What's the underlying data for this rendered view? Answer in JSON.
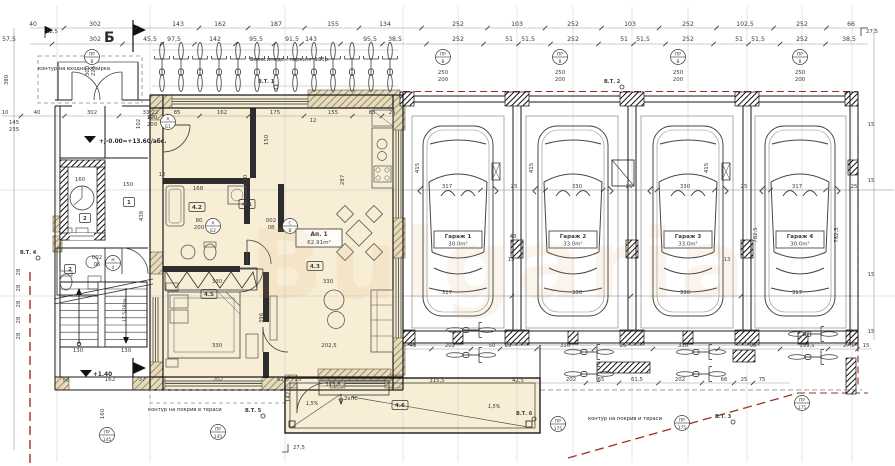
{
  "meta": {
    "type": "architectural-floor-plan",
    "language": "bg"
  },
  "palette": {
    "paper": "#ffffff",
    "ink": "#1a1a1a",
    "dim_text": "#3c3c3c",
    "grid": "#c9c9c9",
    "highlight": "#f8eed6",
    "hatch_tan": "#8a7a55",
    "red_boundary": "#9e2f23",
    "furniture": "#555555",
    "watermark": "#d9a05b"
  },
  "watermark": "Bulgaria",
  "section_marker": "Б",
  "texts": {
    "canopy": "контур на входна козирка",
    "bike_parking": "Велосипеден паркинг 13бр.",
    "roof_terrace_a": "контур на покрив в тераси",
    "roof_terrace_b": "контур на покрив и тераси",
    "level_zero": "+/-0.00=+13.60/абс.",
    "level_stair": "+1.40",
    "stair_note": "17,5/28см.",
    "drain": "2хЛС",
    "slope": "1,5%"
  },
  "apartment": {
    "label": "Ап. 1",
    "area": "62.91m²"
  },
  "rooms": [
    {
      "id": "4.1",
      "x": 247,
      "y": 206
    },
    {
      "id": "4.2",
      "x": 197,
      "y": 209
    },
    {
      "id": "4.3",
      "x": 315,
      "y": 268
    },
    {
      "id": "4.5",
      "x": 209,
      "y": 296
    },
    {
      "id": "4.6",
      "x": 400,
      "y": 407
    },
    {
      "id": "1",
      "x": 129,
      "y": 204
    },
    {
      "id": "2",
      "x": 85,
      "y": 220
    },
    {
      "id": "2",
      "x": 70,
      "y": 271
    }
  ],
  "garages": [
    {
      "name": "Гараж 1",
      "area": "30.0m²",
      "cx": 458
    },
    {
      "name": "Гараж 2",
      "area": "33.0m²",
      "cx": 573
    },
    {
      "name": "Гараж 3",
      "area": "33.0m²",
      "cx": 688
    },
    {
      "name": "Гараж 4",
      "area": "30.0m²",
      "cx": 800
    }
  ],
  "bt_markers": [
    {
      "label": "В.Т. 1",
      "x": 258,
      "y": 83
    },
    {
      "label": "В.Т. 2",
      "x": 604,
      "y": 83
    },
    {
      "label": "В.Т. 4",
      "x": 20,
      "y": 254
    },
    {
      "label": "В.Т. 5",
      "x": 245,
      "y": 412
    },
    {
      "label": "В.Т. 6",
      "x": 516,
      "y": 415
    },
    {
      "label": "В.Т. 3",
      "x": 715,
      "y": 418
    }
  ],
  "door_tags": [
    {
      "a": "ПР",
      "b": "В",
      "x": 92,
      "y": 57
    },
    {
      "a": "А",
      "b": "Б1",
      "x": 168,
      "y": 122
    },
    {
      "a": "А",
      "b": "Б2",
      "x": 213,
      "y": 226
    },
    {
      "a": "С",
      "b": "В",
      "x": 290,
      "y": 226
    },
    {
      "a": "Н",
      "b": "4",
      "x": 113,
      "y": 263
    },
    {
      "a": "ПР",
      "b": "В",
      "x": 443,
      "y": 57
    },
    {
      "a": "ПР",
      "b": "В",
      "x": 560,
      "y": 57
    },
    {
      "a": "ПР",
      "b": "В",
      "x": 678,
      "y": 57
    },
    {
      "a": "ПР",
      "b": "В",
      "x": 800,
      "y": 57
    },
    {
      "a": "ПР",
      "b": "145",
      "x": 107,
      "y": 435
    },
    {
      "a": "ПР",
      "b": "145",
      "x": 218,
      "y": 432
    },
    {
      "a": "ПР",
      "b": "175",
      "x": 558,
      "y": 424
    },
    {
      "a": "ПР",
      "b": "175",
      "x": 682,
      "y": 423
    },
    {
      "a": "ПР",
      "b": "175",
      "x": 802,
      "y": 403
    }
  ],
  "dims": [
    {
      "t": "40",
      "x": 33,
      "y": 26,
      "row": "r1"
    },
    {
      "t": "302",
      "x": 95,
      "y": 26,
      "row": "r1"
    },
    {
      "t": "143",
      "x": 178,
      "y": 26,
      "row": "r1"
    },
    {
      "t": "162",
      "x": 220,
      "y": 26,
      "row": "r1"
    },
    {
      "t": "187",
      "x": 276,
      "y": 26,
      "row": "r1"
    },
    {
      "t": "155",
      "x": 333,
      "y": 26,
      "row": "r1"
    },
    {
      "t": "134",
      "x": 385,
      "y": 26,
      "row": "r1"
    },
    {
      "t": "252",
      "x": 458,
      "y": 26,
      "row": "r1"
    },
    {
      "t": "103",
      "x": 517,
      "y": 26,
      "row": "r1"
    },
    {
      "t": "252",
      "x": 573,
      "y": 26,
      "row": "r1"
    },
    {
      "t": "103",
      "x": 630,
      "y": 26,
      "row": "r1"
    },
    {
      "t": "252",
      "x": 688,
      "y": 26,
      "row": "r1"
    },
    {
      "t": "102,5",
      "x": 745,
      "y": 26,
      "row": "r1"
    },
    {
      "t": "252",
      "x": 802,
      "y": 26,
      "row": "r1"
    },
    {
      "t": "66",
      "x": 851,
      "y": 26,
      "row": "r1"
    },
    {
      "t": "57,5",
      "x": 9,
      "y": 41,
      "row": "r2"
    },
    {
      "t": "302",
      "x": 95,
      "y": 41,
      "row": "r2"
    },
    {
      "t": "45,5",
      "x": 150,
      "y": 41,
      "row": "r2"
    },
    {
      "t": "97,5",
      "x": 174,
      "y": 41,
      "row": "r2"
    },
    {
      "t": "142",
      "x": 215,
      "y": 41,
      "row": "r2"
    },
    {
      "t": "95,5",
      "x": 256,
      "y": 41,
      "row": "r2"
    },
    {
      "t": "91,5",
      "x": 292,
      "y": 41,
      "row": "r2"
    },
    {
      "t": "143",
      "x": 311,
      "y": 41,
      "row": "r2"
    },
    {
      "t": "95,5",
      "x": 370,
      "y": 41,
      "row": "r2"
    },
    {
      "t": "38,5",
      "x": 395,
      "y": 41,
      "row": "r2"
    },
    {
      "t": "252",
      "x": 458,
      "y": 41,
      "row": "r2"
    },
    {
      "t": "51",
      "x": 509,
      "y": 41,
      "row": "r2"
    },
    {
      "t": "51,5",
      "x": 528,
      "y": 41,
      "row": "r2"
    },
    {
      "t": "252",
      "x": 573,
      "y": 41,
      "row": "r2"
    },
    {
      "t": "51",
      "x": 624,
      "y": 41,
      "row": "r2"
    },
    {
      "t": "51,5",
      "x": 643,
      "y": 41,
      "row": "r2"
    },
    {
      "t": "252",
      "x": 688,
      "y": 41,
      "row": "r2"
    },
    {
      "t": "51",
      "x": 739,
      "y": 41,
      "row": "r2"
    },
    {
      "t": "51,5",
      "x": 758,
      "y": 41,
      "row": "r2"
    },
    {
      "t": "252",
      "x": 802,
      "y": 41,
      "row": "r2"
    },
    {
      "t": "38,5",
      "x": 849,
      "y": 41,
      "row": "r2"
    },
    {
      "t": "12,5",
      "x": 52,
      "y": 33
    },
    {
      "t": "27,5",
      "x": 872,
      "y": 33
    },
    {
      "t": "10",
      "x": 5,
      "y": 114,
      "row": "r3"
    },
    {
      "t": "40",
      "x": 37,
      "y": 114,
      "row": "r3"
    },
    {
      "t": "302",
      "x": 92,
      "y": 114,
      "row": "r3"
    },
    {
      "t": "33",
      "x": 146,
      "y": 114,
      "row": "r3"
    },
    {
      "t": "22",
      "x": 155,
      "y": 114,
      "row": "r3"
    },
    {
      "t": "85",
      "x": 177,
      "y": 114,
      "row": "r3"
    },
    {
      "t": "162",
      "x": 222,
      "y": 114,
      "row": "r3"
    },
    {
      "t": "175",
      "x": 275,
      "y": 114,
      "row": "r3"
    },
    {
      "t": "155",
      "x": 333,
      "y": 114,
      "row": "r3"
    },
    {
      "t": "83",
      "x": 372,
      "y": 114,
      "row": "r3"
    },
    {
      "t": "25",
      "x": 392,
      "y": 114,
      "row": "r3"
    },
    {
      "t": "317",
      "x": 447,
      "y": 188,
      "row": "g1"
    },
    {
      "t": "25",
      "x": 514,
      "y": 188,
      "row": "g1"
    },
    {
      "t": "330",
      "x": 577,
      "y": 188,
      "row": "g1"
    },
    {
      "t": "25",
      "x": 629,
      "y": 188,
      "row": "g1"
    },
    {
      "t": "330",
      "x": 685,
      "y": 188,
      "row": "g1"
    },
    {
      "t": "25",
      "x": 744,
      "y": 188,
      "row": "g1"
    },
    {
      "t": "317",
      "x": 797,
      "y": 188,
      "row": "g1"
    },
    {
      "t": "25",
      "x": 854,
      "y": 188,
      "row": "g1"
    },
    {
      "t": "317",
      "x": 447,
      "y": 294,
      "row": "g2"
    },
    {
      "t": "330",
      "x": 577,
      "y": 294,
      "row": "g2"
    },
    {
      "t": "330",
      "x": 685,
      "y": 294,
      "row": "g2"
    },
    {
      "t": "317",
      "x": 797,
      "y": 294,
      "row": "g2"
    },
    {
      "t": "45",
      "x": 413,
      "y": 347,
      "row": "g3"
    },
    {
      "t": "202",
      "x": 450,
      "y": 347,
      "row": "g3"
    },
    {
      "t": "50",
      "x": 492,
      "y": 347,
      "row": "g3"
    },
    {
      "t": "25",
      "x": 508,
      "y": 347,
      "row": "g3"
    },
    {
      "t": "330",
      "x": 565,
      "y": 347,
      "row": "g3"
    },
    {
      "t": "25",
      "x": 623,
      "y": 347,
      "row": "g3"
    },
    {
      "t": "330",
      "x": 683,
      "y": 347,
      "row": "g3"
    },
    {
      "t": "90",
      "x": 753,
      "y": 347,
      "row": "g3"
    },
    {
      "t": "199,5",
      "x": 807,
      "y": 347,
      "row": "g3"
    },
    {
      "t": "27,5",
      "x": 849,
      "y": 347,
      "row": "g3"
    },
    {
      "t": "15",
      "x": 866,
      "y": 347,
      "row": "g3"
    },
    {
      "t": "202",
      "x": 571,
      "y": 381,
      "row": "g4"
    },
    {
      "t": "65",
      "x": 601,
      "y": 381,
      "row": "g4"
    },
    {
      "t": "61,5",
      "x": 637,
      "y": 381,
      "row": "g4"
    },
    {
      "t": "202",
      "x": 680,
      "y": 381,
      "row": "g4"
    },
    {
      "t": "66",
      "x": 724,
      "y": 381,
      "row": "g4"
    },
    {
      "t": "25",
      "x": 744,
      "y": 381,
      "row": "g4"
    },
    {
      "t": "75",
      "x": 762,
      "y": 381,
      "row": "g4"
    },
    {
      "t": "313,5",
      "x": 333,
      "y": 386
    },
    {
      "t": "315,5",
      "x": 437,
      "y": 382
    },
    {
      "t": "42,5",
      "x": 518,
      "y": 382
    },
    {
      "t": "202",
      "x": 218,
      "y": 381
    },
    {
      "t": "62,5",
      "x": 283,
      "y": 381
    },
    {
      "t": "25",
      "x": 298,
      "y": 381
    },
    {
      "t": "162",
      "x": 110,
      "y": 381
    },
    {
      "t": "37",
      "x": 142,
      "y": 381
    },
    {
      "t": "56",
      "x": 66,
      "y": 382
    },
    {
      "t": "380",
      "x": 8,
      "y": 80,
      "v": 1
    },
    {
      "t": "102",
      "x": 140,
      "y": 124,
      "v": 1
    },
    {
      "t": "150",
      "x": 268,
      "y": 140,
      "v": 1
    },
    {
      "t": "170",
      "x": 247,
      "y": 180,
      "v": 1
    },
    {
      "t": "287",
      "x": 344,
      "y": 180,
      "v": 1
    },
    {
      "t": "396",
      "x": 263,
      "y": 318,
      "v": 1
    },
    {
      "t": "438",
      "x": 143,
      "y": 216,
      "v": 1
    },
    {
      "t": "415",
      "x": 419,
      "y": 168,
      "v": 1
    },
    {
      "t": "415",
      "x": 533,
      "y": 168,
      "v": 1
    },
    {
      "t": "415",
      "x": 708,
      "y": 168,
      "v": 1
    },
    {
      "t": "782,5",
      "x": 757,
      "y": 235,
      "v": 1
    },
    {
      "t": "782,5",
      "x": 838,
      "y": 235,
      "v": 1
    },
    {
      "t": "160",
      "x": 104,
      "y": 414,
      "v": 1
    },
    {
      "t": "142",
      "x": 290,
      "y": 397,
      "v": 1
    },
    {
      "t": "300",
      "x": 89,
      "y": 71,
      "v": 1
    },
    {
      "t": "225",
      "x": 95,
      "y": 71,
      "v": 1
    },
    {
      "t": "28",
      "x": 20,
      "y": 272,
      "v": 1
    },
    {
      "t": "28",
      "x": 20,
      "y": 288,
      "v": 1
    },
    {
      "t": "28",
      "x": 20,
      "y": 304,
      "v": 1
    },
    {
      "t": "28",
      "x": 20,
      "y": 320,
      "v": 1
    },
    {
      "t": "28",
      "x": 20,
      "y": 336,
      "v": 1
    },
    {
      "t": "145",
      "x": 14,
      "y": 124
    },
    {
      "t": "235",
      "x": 14,
      "y": 131
    },
    {
      "t": "160",
      "x": 80,
      "y": 181
    },
    {
      "t": "150",
      "x": 128,
      "y": 186
    },
    {
      "t": "168",
      "x": 198,
      "y": 190
    },
    {
      "t": "330",
      "x": 217,
      "y": 283
    },
    {
      "t": "330",
      "x": 328,
      "y": 283
    },
    {
      "t": "330",
      "x": 217,
      "y": 347
    },
    {
      "t": "202,5",
      "x": 329,
      "y": 347
    },
    {
      "t": "130",
      "x": 78,
      "y": 352
    },
    {
      "t": "130",
      "x": 126,
      "y": 352
    },
    {
      "t": "12",
      "x": 313,
      "y": 122
    },
    {
      "t": "12",
      "x": 162,
      "y": 176
    },
    {
      "t": "43",
      "x": 513,
      "y": 238
    },
    {
      "t": "13",
      "x": 511,
      "y": 261
    },
    {
      "t": "13",
      "x": 727,
      "y": 261
    },
    {
      "t": "15",
      "x": 871,
      "y": 126
    },
    {
      "t": "15",
      "x": 871,
      "y": 182
    },
    {
      "t": "15",
      "x": 871,
      "y": 276
    },
    {
      "t": "15",
      "x": 871,
      "y": 333
    },
    {
      "t": "27,5",
      "x": 299,
      "y": 449
    },
    {
      "t": "100",
      "x": 152,
      "y": 119
    },
    {
      "t": "200",
      "x": 152,
      "y": 126
    },
    {
      "t": "80",
      "x": 199,
      "y": 222
    },
    {
      "t": "200",
      "x": 199,
      "y": 229
    },
    {
      "t": "002",
      "x": 271,
      "y": 222
    },
    {
      "t": "08",
      "x": 271,
      "y": 229
    },
    {
      "t": "002",
      "x": 97,
      "y": 259
    },
    {
      "t": "06",
      "x": 97,
      "y": 266
    },
    {
      "t": "250",
      "x": 443,
      "y": 74
    },
    {
      "t": "200",
      "x": 443,
      "y": 81
    },
    {
      "t": "250",
      "x": 560,
      "y": 74
    },
    {
      "t": "200",
      "x": 560,
      "y": 81
    },
    {
      "t": "250",
      "x": 678,
      "y": 74
    },
    {
      "t": "200",
      "x": 678,
      "y": 81
    },
    {
      "t": "250",
      "x": 800,
      "y": 74
    },
    {
      "t": "200",
      "x": 800,
      "y": 81
    }
  ]
}
